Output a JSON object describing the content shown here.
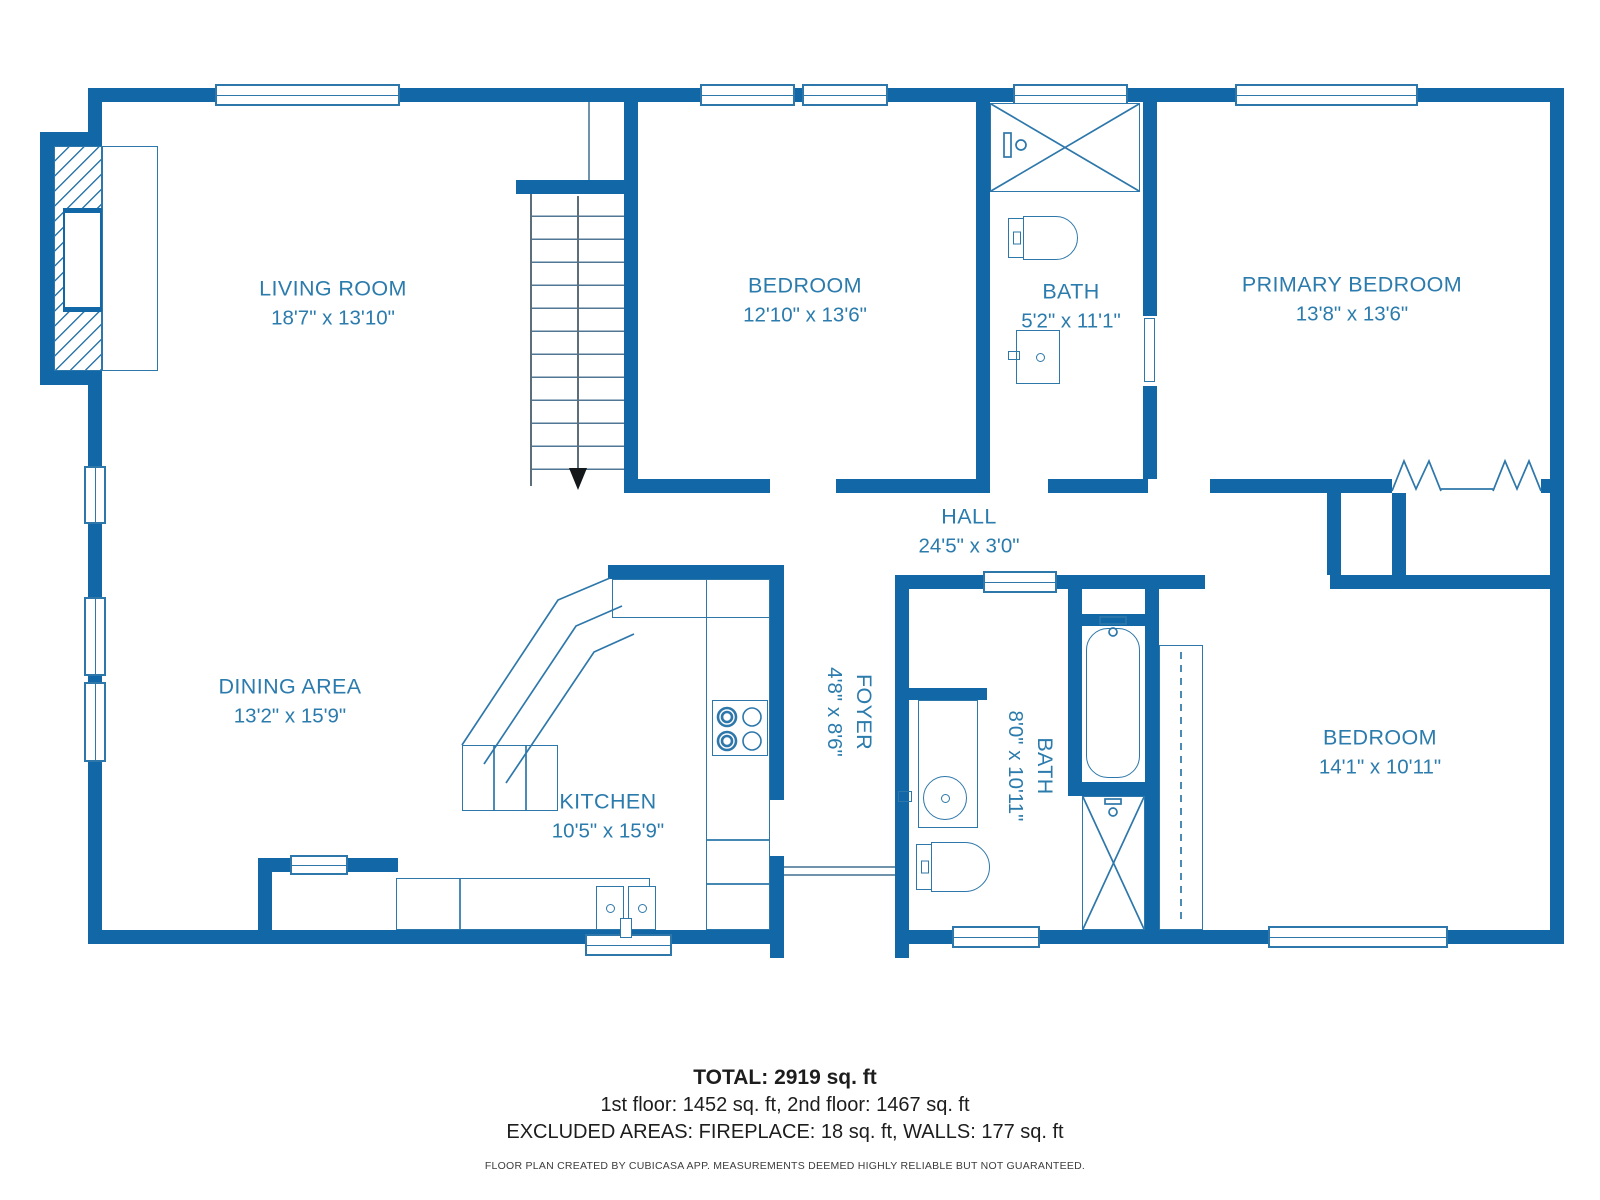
{
  "rooms": [
    {
      "name": "LIVING ROOM",
      "dims": "18'7\" x 13'10\""
    },
    {
      "name": "BEDROOM",
      "dims": "12'10\" x 13'6\""
    },
    {
      "name": "BATH",
      "dims": "5'2\" x 11'1\""
    },
    {
      "name": "PRIMARY BEDROOM",
      "dims": "13'8\" x 13'6\""
    },
    {
      "name": "HALL",
      "dims": "24'5\" x 3'0\""
    },
    {
      "name": "DINING AREA",
      "dims": "13'2\" x 15'9\""
    },
    {
      "name": "KITCHEN",
      "dims": "10'5\" x 15'9\""
    },
    {
      "name": "FOYER",
      "dims": "4'8\" x 8'6\""
    },
    {
      "name": "BATH",
      "dims": "8'0\" x 10'11\""
    },
    {
      "name": "BEDROOM",
      "dims": "14'1\" x 10'11\""
    }
  ],
  "footer": {
    "total": "TOTAL: 2919 sq. ft",
    "floors": "1st floor: 1452 sq. ft, 2nd floor: 1467 sq. ft",
    "excluded": "EXCLUDED AREAS: FIREPLACE: 18 sq. ft, WALLS: 177 sq. ft",
    "disclaimer": "FLOOR PLAN CREATED BY CUBICASA APP. MEASUREMENTS DEEMED HIGHLY RELIABLE BUT NOT GUARANTEED."
  },
  "colors": {
    "wall": "#1268a6",
    "thin_line": "#2d77aa",
    "label_text": "#2b7bad",
    "footer_text": "#1d1d1d"
  }
}
